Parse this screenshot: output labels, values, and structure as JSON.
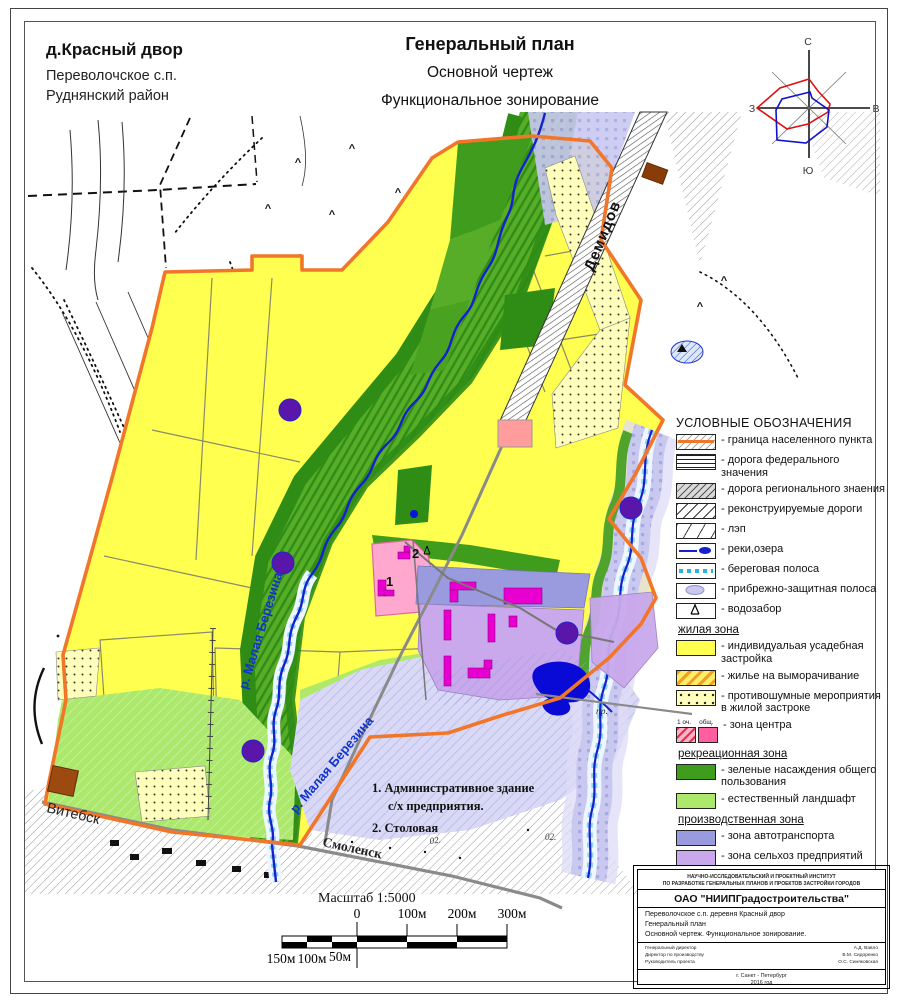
{
  "page": {
    "place_title": "д.Красный двор",
    "place_sub1": "Переволочское с.п.",
    "place_sub2": "Руднянский район",
    "title1": "Генеральный план",
    "title2": "Основной чертеж",
    "title3": "Функциональное зонирование"
  },
  "compass": {
    "n": "С",
    "s": "Ю",
    "e": "В",
    "w": "З"
  },
  "map_labels": {
    "road_demidov": "Демидов",
    "road_vitebsk": "Витебск",
    "road_smolensk": "Смоленск",
    "river1": "р. Малая Березина",
    "river2": "р. Малая Березина",
    "note1a": "1. Административное здание",
    "note1b": "с/х предприятия.",
    "note2": "2. Столовая",
    "scale_text": "Масштаб 1:5000",
    "pr": "пр.",
    "bld1": "1",
    "bld2": "2",
    "mark1": "02.",
    "mark2": "02."
  },
  "scalebar": {
    "top": [
      "0",
      "100м",
      "200м",
      "300м"
    ],
    "bottom": [
      "150м",
      "100м",
      "50м"
    ]
  },
  "legend": {
    "title": "УСЛОВНЫЕ ОБОЗНАЧЕНИЯ",
    "general": [
      "- граница населенного пункта",
      "- дорога федерального значения",
      "- дорога регионального знаения",
      "- реконструируемые дороги",
      "- лэп",
      "- реки,озера",
      "- береговая полоса",
      "- прибрежно-защитная полоса",
      "- водозабор"
    ],
    "residential_title": "жилая зона",
    "residential": [
      "- индивидуальая усадебная застройка",
      "- жилье на выморачивание",
      "- противошумные мероприятия в жилой застроке",
      "- зона центра"
    ],
    "center_sub1": "1 оч.",
    "center_sub2": "общ.",
    "recreation_title": "рекреационная зона",
    "recreation": [
      "- зеленые насаждения общего пользования",
      "- естественный ландшафт"
    ],
    "industrial_title": "производственная зона",
    "industrial": [
      "- зона автотранспорта",
      "- зона сельхоз предприятий",
      "- санитарно-защитная зона",
      "- пожарный водозабор",
      "- мусоро - контейнерная площадка",
      "- мост",
      "- автобусный павильон"
    ]
  },
  "stamp": {
    "institute_line1": "НАУЧНО-ИССЛЕДОВАТЕЛЬСКИЙ И ПРОЕКТНЫЙ ИНСТИТУТ",
    "institute_line2": "ПО РАЗРАБОТКЕ ГЕНЕРАЛЬНЫХ ПЛАНОВ И ПРОЕКТОВ ЗАСТРОЙКИ ГОРОДОВ",
    "org": "ОАО \"НИИПГрадостроительства\"",
    "row1": "Переволочское с.п. деревня Красный двор",
    "row2": "Генеральный план",
    "row3": "Основной чертеж. Функциональное зонирование.",
    "sig_title1": "Генеральный директор",
    "sig_title2": "Директор по производству",
    "sig_title3": "Руководитель проекта",
    "sig_name1": "А.Д. Вавло",
    "sig_name2": "В.М. Сидоренко",
    "sig_name3": "О.С. Синяковская",
    "city": "г. Санкт - Петербург",
    "year": "2016 год"
  },
  "colors": {
    "boundary_orange": "#f2762a",
    "residential_yellow": "#ffff4f",
    "noise_yellow": "#ffffbb",
    "green_public": "#3f9c1c",
    "green_dark": "#2f8c15",
    "green_medium": "#57ad28",
    "landscape_green": "#abe86b",
    "transport_purple": "#9a9ade",
    "agro_purple": "#c9a8ec",
    "building_magenta": "#e800d0",
    "center_pink": "#ffa8cf",
    "river_blue": "#1421cc",
    "flood_periwinkle": "#c9c9f0",
    "fire_purple": "#5a16aa",
    "waste_brown": "#9c4a10",
    "lake_blue": "#0a0ad6"
  }
}
